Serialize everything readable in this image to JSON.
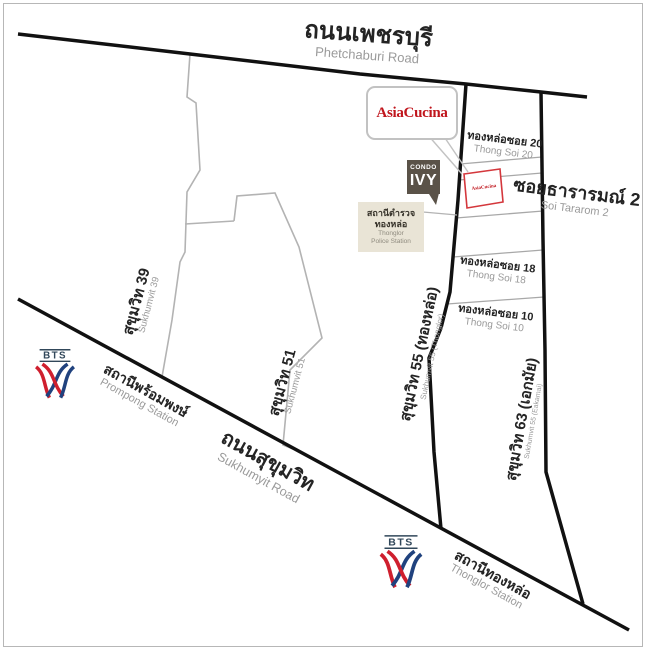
{
  "canvas": {
    "width": 646,
    "height": 650,
    "background": "#ffffff",
    "frame_color": "#b7b7b7"
  },
  "colors": {
    "main_road": "#111111",
    "minor_road_gray": "#b3b3b3",
    "soi_line_gray": "#a8a8a8",
    "thai_label": "#242424",
    "eng_label": "#9a9a9a",
    "asiacucina_red": "#c0161d",
    "site_box_red": "#d4373c",
    "bts_navy": "#20427e",
    "bts_red": "#cf1f2e",
    "bts_wordmark": "#31475a",
    "police_bg": "#e9e4d6",
    "condo_bg": "#5a5248"
  },
  "labels": {
    "phetchaburi": {
      "thai": "ถนนเพชรบุรี",
      "eng": "Phetchaburi Road"
    },
    "sukhumvit_road": {
      "thai": "ถนนสุขุมวิท",
      "eng": "Sukhumyit Road"
    },
    "sukhumvit_39": {
      "thai": "สุขุมวิท 39",
      "eng": "Sukhumvit 39"
    },
    "sukhumvit_51": {
      "thai": "สุขุมวิท 51",
      "eng": "Sukhumvit 51"
    },
    "sukhumvit_55": {
      "thai": "สุขุมวิท 55 (ทองหล่อ)",
      "eng": "Sukhumvit 55 (Thonglor)"
    },
    "sukhumvit_63": {
      "thai": "สุขุมวิท 63 (เอกมัย)",
      "eng": "Sukhumvit 55 (Eakamai)"
    },
    "thong_soi_20": {
      "thai": "ทองหล่อซอย 20",
      "eng": "Thong Soi 20"
    },
    "soi_tararom_2": {
      "thai": "ซอยธารารมณ์ 2",
      "eng": "Soi Tararom 2"
    },
    "thong_soi_18": {
      "thai": "ทองหล่อซอย 18",
      "eng": "Thong Soi 18"
    },
    "thong_soi_10": {
      "thai": "ทองหล่อซอย 10",
      "eng": "Thong Soi 10"
    }
  },
  "places": {
    "asiacucina_callout": {
      "label": "AsiaCucina"
    },
    "asiacucina_site": {
      "label": "AsiaCucina"
    },
    "condo_ivy": {
      "line1": "CONDO",
      "line2": "IVY"
    },
    "police_station": {
      "thai_line1": "สถานีตำรวจ",
      "thai_line2": "ทองหล่อ",
      "eng_line1": "Thonglor",
      "eng_line2": "Police Station"
    }
  },
  "stations": {
    "bts_label": "BTS",
    "prompong": {
      "thai": "สถานีพร้อมพงษ์",
      "eng": "Prompong Station"
    },
    "thonglor": {
      "thai": "สถานีทองหล่อ",
      "eng": "Thonglor Station"
    }
  }
}
